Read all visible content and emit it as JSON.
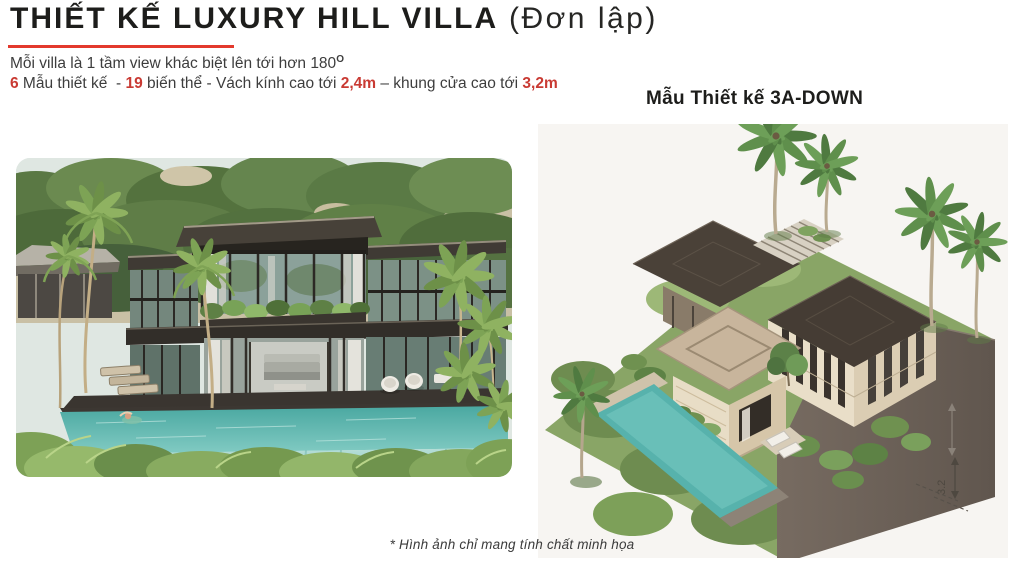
{
  "header": {
    "title_main": "THIẾT KẾ LUXURY HILL VILLA",
    "title_suffix": " (Đơn lập)",
    "tagline": "Mỗi villa là 1 tầm view khác biệt lên tới hơn 180",
    "tagline_sup": "O",
    "specs": [
      {
        "text": "6",
        "highlight": true
      },
      {
        "text": " Mẫu thiết kế  - ",
        "highlight": false
      },
      {
        "text": "19",
        "highlight": true
      },
      {
        "text": " biến thể - Vách kính cao tới ",
        "highlight": false
      },
      {
        "text": "2,4m",
        "highlight": true
      },
      {
        "text": " – khung cửa cao tới ",
        "highlight": false
      },
      {
        "text": "3,2m",
        "highlight": true
      }
    ]
  },
  "right_panel": {
    "heading": "Mẫu Thiết kế 3A-DOWN",
    "dimension_label": "3.2"
  },
  "footer": {
    "caption": "* Hình ảnh chỉ mang tính chất minh họa"
  },
  "colors": {
    "accent_red": "#C93A33",
    "underline_red": "#E3392D",
    "title_text": "#1D1D1B",
    "body_text": "#3D3D3D",
    "render_background": "#F7F5F2",
    "pool_teal": "#57B2AC",
    "roof_brown": "#4A4138",
    "grass_green": "#89A566"
  }
}
